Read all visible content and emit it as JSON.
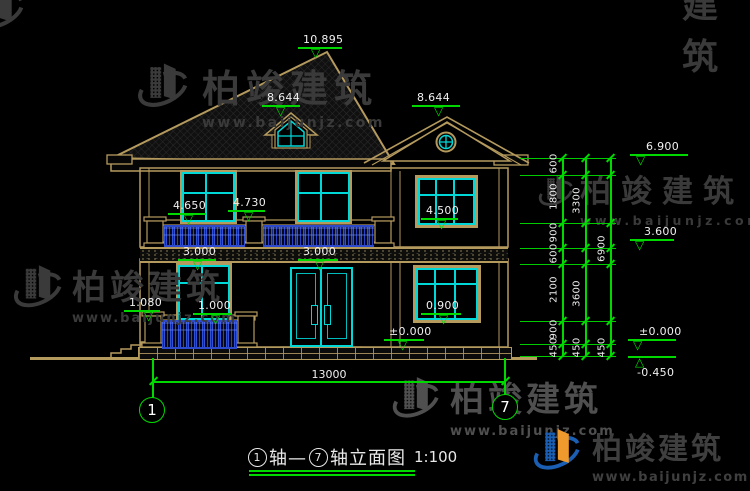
{
  "watermark": {
    "company": "柏竣建筑",
    "url": "www.baijunjz.com",
    "fragment": "建筑"
  },
  "elevation_labels": {
    "ridge": "10.895",
    "dormer": "8.644",
    "gable": "8.644",
    "balcony_door_sill": "4.650",
    "balcony_rail_top": "4.730",
    "window_2f_sill": "4.500",
    "balcony_floor_a": "3.000",
    "balcony_floor_b": "3.000",
    "porch_rail_a": "1.080",
    "porch_rail_b": "1.000",
    "window_1f_sill": "0.900",
    "ground_door": "±0.000"
  },
  "right_markers": {
    "eave": "6.900",
    "floor2": "3.600",
    "ground": "±0.000",
    "site": "-0.450"
  },
  "dim_chain": {
    "col1": [
      "600",
      "1800",
      "900",
      "600",
      "2100",
      "900",
      "450"
    ],
    "col2": [
      "3300",
      "3600",
      "450"
    ],
    "col3": [
      "6900",
      "450"
    ]
  },
  "plan": {
    "total_width": "13000",
    "axis_left": "1",
    "axis_right": "7"
  },
  "title": {
    "axis_left": "1",
    "segment": "轴—",
    "axis_right": "7",
    "name": "轴立面图",
    "scale": "1:100"
  }
}
